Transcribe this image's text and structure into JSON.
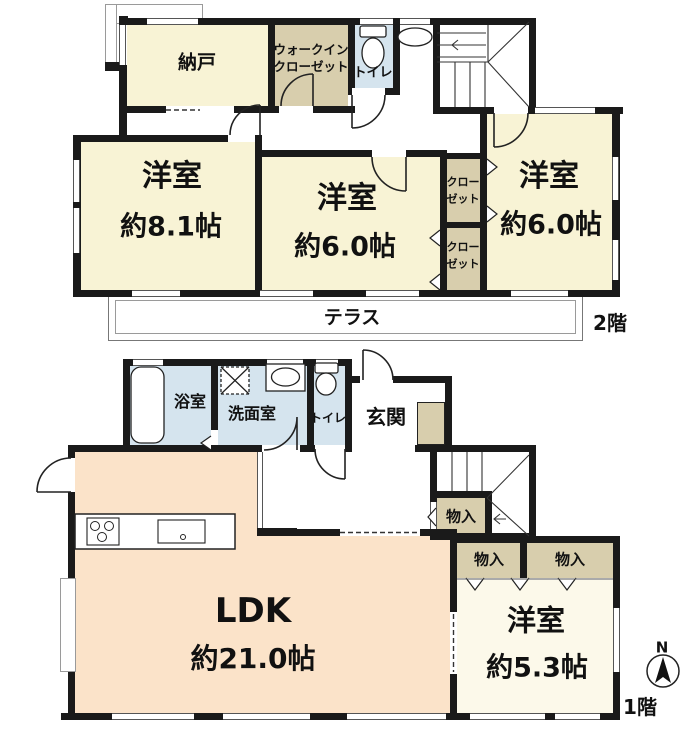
{
  "floor2": {
    "label": "2階",
    "nando": "納戸",
    "wic_line1": "ウォークイン",
    "wic_line2": "クローゼット",
    "toilet": "トイレ",
    "room81_name": "洋室",
    "room81_size": "約8.1帖",
    "room60m_name": "洋室",
    "room60m_size": "約6.0帖",
    "room60r_name": "洋室",
    "room60r_size": "約6.0帖",
    "closet_line1": "クロー",
    "closet_line2": "ゼット",
    "terrace": "テラス"
  },
  "floor1": {
    "label": "1階",
    "bath": "浴室",
    "wash": "洗面室",
    "toilet": "トイレ",
    "genkan": "玄関",
    "ldk_name": "LDK",
    "ldk_size": "約21.0帖",
    "room53_name": "洋室",
    "room53_size": "約5.3帖",
    "storage": "物入"
  },
  "compass": {
    "north": "N"
  },
  "colors": {
    "wall": "#1a1a1a",
    "room_cream": "#f8f3d5",
    "closet_tan": "#d8cead",
    "wet_blue": "#d5e4ee",
    "ldk_peach": "#fbe3c9",
    "room_pale": "#fcf9ea"
  }
}
